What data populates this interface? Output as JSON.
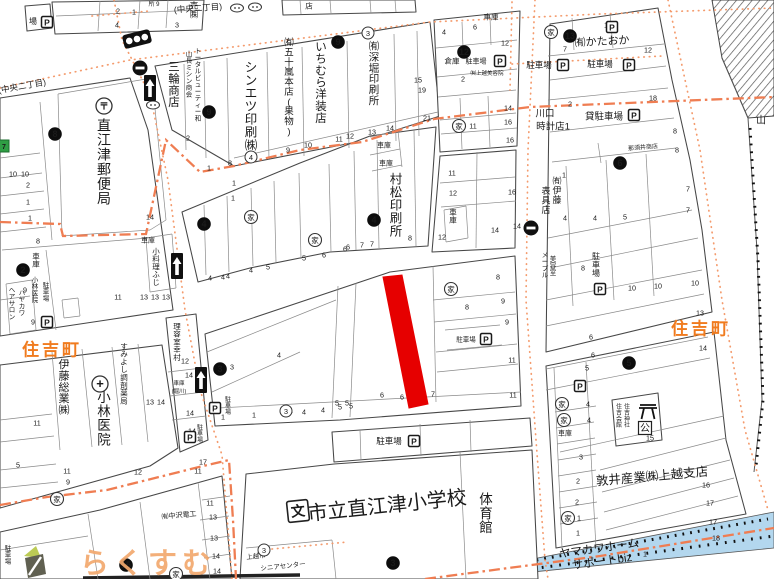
{
  "map": {
    "district_labels": [
      {
        "text": "住吉町",
        "x": 52,
        "y": 348
      },
      {
        "text": "住吉町",
        "x": 701,
        "y": 327
      }
    ],
    "watermark": {
      "text": "らくすむ"
    },
    "highlighted_parcel": {
      "points": "383,277 402,275 428,404 409,408",
      "color": "#e60000"
    },
    "glyphs": {
      "house": "家",
      "post": "〒",
      "hospital": "+",
      "parking": "P",
      "school": "文",
      "public_hall": "公"
    },
    "place_labels": [
      {
        "t": "直江津郵便局",
        "x": 104,
        "y": 118,
        "o": "v",
        "s": 14
      },
      {
        "t": "三輪商店",
        "x": 174,
        "y": 60,
        "o": "v",
        "s": 11.5
      },
      {
        "t": "山長ミシン商会",
        "x": 189,
        "y": 50,
        "o": "v",
        "s": 6.5
      },
      {
        "t": "トータルビューティー和",
        "x": 198,
        "y": 47,
        "o": "v",
        "s": 6.5
      },
      {
        "t": "シンエツ印刷㈱",
        "x": 251,
        "y": 60,
        "o": "v",
        "s": 12.5
      },
      {
        "t": "㈲五十嵐本店(果物)",
        "x": 289,
        "y": 37,
        "o": "v",
        "s": 9.5
      },
      {
        "t": "いちむら洋装店",
        "x": 321,
        "y": 40,
        "o": "v",
        "s": 11.5
      },
      {
        "t": "㈲深堀印刷所",
        "x": 374,
        "y": 40,
        "o": "v",
        "s": 10.5
      },
      {
        "t": "村松印刷所",
        "x": 396,
        "y": 172,
        "o": "v",
        "s": 12.5
      },
      {
        "t": "㈲伊藤",
        "x": 557,
        "y": 176,
        "o": "v",
        "s": 9
      },
      {
        "t": "表具店",
        "x": 546,
        "y": 186,
        "o": "v",
        "s": 9
      },
      {
        "t": "メープル",
        "x": 545,
        "y": 251,
        "o": "v",
        "s": 6.5
      },
      {
        "t": "美容室",
        "x": 553,
        "y": 255,
        "o": "v",
        "s": 6.5
      },
      {
        "t": "駐車場",
        "x": 596,
        "y": 252,
        "o": "v",
        "s": 8
      },
      {
        "t": "小料理ふじ",
        "x": 156,
        "y": 247,
        "o": "v",
        "s": 7.5
      },
      {
        "t": "車庫",
        "x": 36,
        "y": 252,
        "o": "v",
        "s": 7.5
      },
      {
        "t": "小林医院",
        "x": 35,
        "y": 276,
        "o": "v",
        "s": 6.5
      },
      {
        "t": "駐車場",
        "x": 46,
        "y": 281,
        "o": "v",
        "s": 6.5
      },
      {
        "t": "ヘアサロン",
        "x": 12,
        "y": 286,
        "o": "v",
        "s": 6.5
      },
      {
        "t": "ハヤカワ",
        "x": 22,
        "y": 289,
        "o": "v",
        "s": 6.5
      },
      {
        "t": "伊藤総業㈱",
        "x": 64,
        "y": 358,
        "o": "v",
        "s": 11
      },
      {
        "t": "小林医院",
        "x": 104,
        "y": 390,
        "o": "v",
        "s": 13.5
      },
      {
        "t": "すみよし調剤薬局",
        "x": 124,
        "y": 342,
        "o": "v",
        "s": 7.5
      },
      {
        "t": "理容室幸村",
        "x": 177,
        "y": 322,
        "o": "v",
        "s": 7.5
      },
      {
        "t": "体育館",
        "x": 486,
        "y": 492,
        "o": "v",
        "s": 13.5
      },
      {
        "t": "駐車場",
        "x": 8,
        "y": 544,
        "o": "v",
        "s": 6.5
      },
      {
        "t": "住吉会館",
        "x": 619,
        "y": 403,
        "o": "v",
        "s": 6
      },
      {
        "t": "住吉神社",
        "x": 627,
        "y": 403,
        "o": "v",
        "s": 6
      },
      {
        "t": "車庫",
        "x": 453,
        "y": 208,
        "o": "v",
        "s": 7.5
      },
      {
        "t": "駐車場",
        "x": 228,
        "y": 396,
        "o": "v",
        "s": 6
      },
      {
        "t": "駐車場",
        "x": 200,
        "y": 424,
        "o": "v",
        "s": 6
      },
      {
        "t": "売㈱",
        "x": 194,
        "y": 1,
        "o": "v",
        "s": 8.5
      },
      {
        "t": "(中央二丁目)",
        "x": 22,
        "y": 86,
        "s": 8.5,
        "r": -10
      },
      {
        "t": "(中央二丁目)",
        "x": 198,
        "y": 8,
        "s": 8.5,
        "r": -4
      },
      {
        "t": "所 9",
        "x": 154,
        "y": 4,
        "s": 6
      },
      {
        "t": "店",
        "x": 309,
        "y": 6,
        "s": 7.5
      },
      {
        "t": "場",
        "x": 33,
        "y": 21,
        "s": 8
      },
      {
        "t": "車庫",
        "x": 491,
        "y": 17,
        "s": 7.5
      },
      {
        "t": "倉庫",
        "x": 452,
        "y": 61,
        "s": 7.5
      },
      {
        "t": "駐車場",
        "x": 476,
        "y": 61,
        "s": 7
      },
      {
        "t": "㈲上越美容院",
        "x": 487,
        "y": 73,
        "s": 5.5
      },
      {
        "t": "㈲かたおか",
        "x": 602,
        "y": 41,
        "s": 11,
        "r": -3
      },
      {
        "t": "駐車場",
        "x": 539,
        "y": 65,
        "s": 8.5
      },
      {
        "t": "駐車場",
        "x": 600,
        "y": 64,
        "s": 8.5
      },
      {
        "t": "貸駐車場",
        "x": 604,
        "y": 116,
        "s": 9.5
      },
      {
        "t": "川口",
        "x": 545,
        "y": 113,
        "s": 9.5
      },
      {
        "t": "時計店1",
        "x": 553,
        "y": 126,
        "s": 9.5
      },
      {
        "t": "那須井商店",
        "x": 643,
        "y": 147,
        "s": 6,
        "r": -5
      },
      {
        "t": "車庫",
        "x": 384,
        "y": 145,
        "s": 7
      },
      {
        "t": "車庫",
        "x": 386,
        "y": 163,
        "s": 7
      },
      {
        "t": "車庫",
        "x": 148,
        "y": 240,
        "s": 7
      },
      {
        "t": "車庫",
        "x": 179,
        "y": 383,
        "s": 5.5
      },
      {
        "t": "(堀川)",
        "x": 179,
        "y": 391,
        "s": 5.5
      },
      {
        "t": "㈲中沢電工",
        "x": 179,
        "y": 515,
        "s": 7,
        "r": -5
      },
      {
        "t": "駐車場",
        "x": 389,
        "y": 441,
        "s": 8.5
      },
      {
        "t": "市立直江津小学校",
        "x": 387,
        "y": 505,
        "s": 20,
        "r": -6
      },
      {
        "t": "上越市",
        "x": 256,
        "y": 556,
        "s": 6.5,
        "r": -6
      },
      {
        "t": "シニアセンター",
        "x": 283,
        "y": 566,
        "s": 6.5,
        "r": -6
      },
      {
        "t": "敦井産業㈱上越支店",
        "x": 652,
        "y": 476,
        "s": 12.5,
        "r": -5
      },
      {
        "t": "ヤマカワホーム",
        "x": 599,
        "y": 548,
        "s": 11.5,
        "r": -8
      },
      {
        "t": "サポートbiz",
        "x": 602,
        "y": 561,
        "s": 11.5,
        "r": -8
      },
      {
        "t": "山",
        "x": 761,
        "y": 120,
        "s": 10
      },
      {
        "t": "駐車場",
        "x": 466,
        "y": 339,
        "s": 6.5
      },
      {
        "t": "車庫",
        "x": 565,
        "y": 433,
        "s": 7
      }
    ],
    "lot_numbers": [
      [
        "2",
        118,
        11
      ],
      [
        "1",
        134,
        12
      ],
      [
        "4",
        117,
        25
      ],
      [
        "3",
        177,
        25
      ],
      [
        "10",
        13,
        174
      ],
      [
        "10",
        25,
        174
      ],
      [
        "2",
        28,
        185
      ],
      [
        "1",
        28,
        202
      ],
      [
        "1",
        30,
        218
      ],
      [
        "8",
        38,
        241
      ],
      [
        "9",
        25,
        290
      ],
      [
        "9",
        33,
        322
      ],
      [
        "14",
        150,
        217
      ],
      [
        "11",
        118,
        297
      ],
      [
        "13",
        144,
        297
      ],
      [
        "13",
        155,
        297
      ],
      [
        "13",
        166,
        297
      ],
      [
        "12",
        185,
        361
      ],
      [
        "14",
        189,
        375
      ],
      [
        "14",
        190,
        413
      ],
      [
        "13",
        150,
        402
      ],
      [
        "14",
        161,
        402
      ],
      [
        "14",
        192,
        431
      ],
      [
        "8",
        230,
        163
      ],
      [
        "9",
        288,
        150
      ],
      [
        "10",
        308,
        145
      ],
      [
        "11",
        339,
        139
      ],
      [
        "12",
        350,
        136
      ],
      [
        "13",
        372,
        132
      ],
      [
        "14",
        390,
        128
      ],
      [
        "15",
        418,
        80
      ],
      [
        "19",
        422,
        90
      ],
      [
        "21",
        427,
        118
      ],
      [
        "4",
        444,
        32
      ],
      [
        "6",
        475,
        27
      ],
      [
        "12",
        505,
        43
      ],
      [
        "2",
        463,
        79
      ],
      [
        "10",
        608,
        25
      ],
      [
        "7",
        565,
        49
      ],
      [
        "12",
        648,
        50
      ],
      [
        "2",
        570,
        104
      ],
      [
        "18",
        653,
        98
      ],
      [
        "14",
        508,
        108
      ],
      [
        "16",
        508,
        122
      ],
      [
        "11",
        473,
        126
      ],
      [
        "16",
        510,
        140
      ],
      [
        "1",
        564,
        175
      ],
      [
        "8",
        675,
        131
      ],
      [
        "8",
        677,
        150
      ],
      [
        "7",
        688,
        189
      ],
      [
        "7",
        688,
        210
      ],
      [
        "4",
        565,
        218
      ],
      [
        "4",
        595,
        218
      ],
      [
        "5",
        625,
        217
      ],
      [
        "8",
        583,
        268
      ],
      [
        "11",
        452,
        173
      ],
      [
        "12",
        453,
        193
      ],
      [
        "16",
        512,
        192
      ],
      [
        "12",
        442,
        237
      ],
      [
        "14",
        495,
        230
      ],
      [
        "14",
        517,
        226
      ],
      [
        "8",
        410,
        238
      ],
      [
        "6",
        348,
        247
      ],
      [
        "7",
        362,
        245
      ],
      [
        "7",
        372,
        244
      ],
      [
        "2",
        188,
        138
      ],
      [
        "1",
        209,
        168
      ],
      [
        "1",
        234,
        183
      ],
      [
        "1",
        233,
        198
      ],
      [
        "4",
        210,
        278
      ],
      [
        "4",
        223,
        277
      ],
      [
        "4",
        228,
        276
      ],
      [
        "4",
        251,
        270
      ],
      [
        "5",
        268,
        267
      ],
      [
        "5",
        304,
        258
      ],
      [
        "6",
        324,
        255
      ],
      [
        "6",
        345,
        249
      ],
      [
        "8",
        498,
        277
      ],
      [
        "8",
        467,
        307
      ],
      [
        "9",
        503,
        301
      ],
      [
        "9",
        507,
        322
      ],
      [
        "11",
        512,
        360
      ],
      [
        "11",
        513,
        395
      ],
      [
        "5",
        337,
        403
      ],
      [
        "5",
        347,
        403
      ],
      [
        "6",
        382,
        395
      ],
      [
        "6",
        402,
        397
      ],
      [
        "7",
        433,
        394
      ],
      [
        "4",
        279,
        355
      ],
      [
        "3",
        232,
        367
      ],
      [
        "1",
        254,
        415
      ],
      [
        "4",
        304,
        412
      ],
      [
        "5",
        340,
        407
      ],
      [
        "5",
        351,
        406
      ],
      [
        "1",
        223,
        417
      ],
      [
        "1",
        291,
        410
      ],
      [
        "4",
        323,
        410
      ],
      [
        "17",
        203,
        462
      ],
      [
        "11",
        210,
        503
      ],
      [
        "13",
        213,
        517
      ],
      [
        "13",
        214,
        538
      ],
      [
        "14",
        216,
        556
      ],
      [
        "14",
        217,
        571
      ],
      [
        "5",
        18,
        465
      ],
      [
        "11",
        37,
        423
      ],
      [
        "11",
        67,
        471
      ],
      [
        "9",
        68,
        482
      ],
      [
        "12",
        138,
        472
      ],
      [
        "11",
        198,
        471
      ],
      [
        "10",
        632,
        288
      ],
      [
        "10",
        658,
        286
      ],
      [
        "10",
        695,
        283
      ],
      [
        "13",
        700,
        313
      ],
      [
        "14",
        703,
        348
      ],
      [
        "6",
        591,
        337
      ],
      [
        "6",
        593,
        355
      ],
      [
        "5",
        587,
        368
      ],
      [
        "4",
        588,
        404
      ],
      [
        "4",
        589,
        420
      ],
      [
        "3",
        581,
        457
      ],
      [
        "2",
        578,
        481
      ],
      [
        "2",
        577,
        502
      ],
      [
        "1",
        579,
        518
      ],
      [
        "1",
        578,
        533
      ],
      [
        "16",
        706,
        485
      ],
      [
        "17",
        710,
        503
      ],
      [
        "17",
        713,
        522
      ],
      [
        "18",
        716,
        538
      ],
      [
        "1",
        645,
        554
      ],
      [
        "15",
        650,
        438
      ]
    ],
    "black_markers": [
      [
        "8",
        55,
        134
      ],
      [
        "9",
        209,
        112
      ],
      [
        "9",
        338,
        42
      ],
      [
        "12",
        464,
        52
      ],
      [
        "13",
        570,
        36
      ],
      [
        "4",
        374,
        220
      ],
      [
        "4",
        204,
        224
      ],
      [
        "2",
        23,
        270
      ],
      [
        "3",
        220,
        369
      ],
      [
        "15",
        126,
        565
      ],
      [
        "3",
        393,
        563
      ],
      [
        "5",
        629,
        363
      ],
      [
        "6",
        620,
        163
      ]
    ],
    "white_markers": [
      [
        "3",
        368,
        33
      ],
      [
        "4",
        251,
        157
      ],
      [
        "3",
        286,
        411
      ],
      [
        "3",
        264,
        550
      ]
    ],
    "house_icons": [
      [
        551,
        32
      ],
      [
        459,
        126
      ],
      [
        451,
        289
      ],
      [
        251,
        217
      ],
      [
        315,
        240
      ],
      [
        57,
        499
      ],
      [
        176,
        574
      ],
      [
        562,
        404
      ],
      [
        564,
        420
      ],
      [
        568,
        518
      ]
    ],
    "parking_icons": [
      [
        47,
        22
      ],
      [
        500,
        61
      ],
      [
        563,
        65
      ],
      [
        629,
        65
      ],
      [
        634,
        115
      ],
      [
        612,
        27
      ],
      [
        486,
        339
      ],
      [
        600,
        289
      ],
      [
        47,
        322
      ],
      [
        580,
        386
      ],
      [
        215,
        408
      ],
      [
        190,
        437
      ],
      [
        414,
        441
      ]
    ],
    "bus_stop_icons": [
      [
        237,
        8
      ],
      [
        255,
        7
      ],
      [
        153,
        105
      ]
    ],
    "one_way_arrow_icons": [
      [
        150,
        88
      ],
      [
        177,
        266
      ],
      [
        201,
        380
      ]
    ],
    "no_entry_icons": [
      [
        140,
        68
      ],
      [
        531,
        228
      ]
    ],
    "traffic_light_icon": {
      "x": 137,
      "y": 39,
      "rotation": -14
    },
    "post_office_icon": {
      "x": 104,
      "y": 106
    },
    "hospital_icon": {
      "x": 100,
      "y": 384
    },
    "school_icon": {
      "x": 298,
      "y": 511
    },
    "torii_icon": {
      "x": 648,
      "y": 412
    },
    "public_hall_icon": {
      "x": 645,
      "y": 428
    },
    "green_lot_box": {
      "x": 4,
      "y": 146,
      "text": "7"
    },
    "colors": {
      "highlight": "#e60000",
      "boundary": "#ef7d52",
      "road_dots": "#f49b6d",
      "water": "#b3d7ee",
      "district_text": "#f07b1e",
      "watermark_text": "#f2a96e",
      "block_line": "#474747",
      "parcel_line": "#8a8a8a",
      "text": "#1a1a1a"
    }
  }
}
